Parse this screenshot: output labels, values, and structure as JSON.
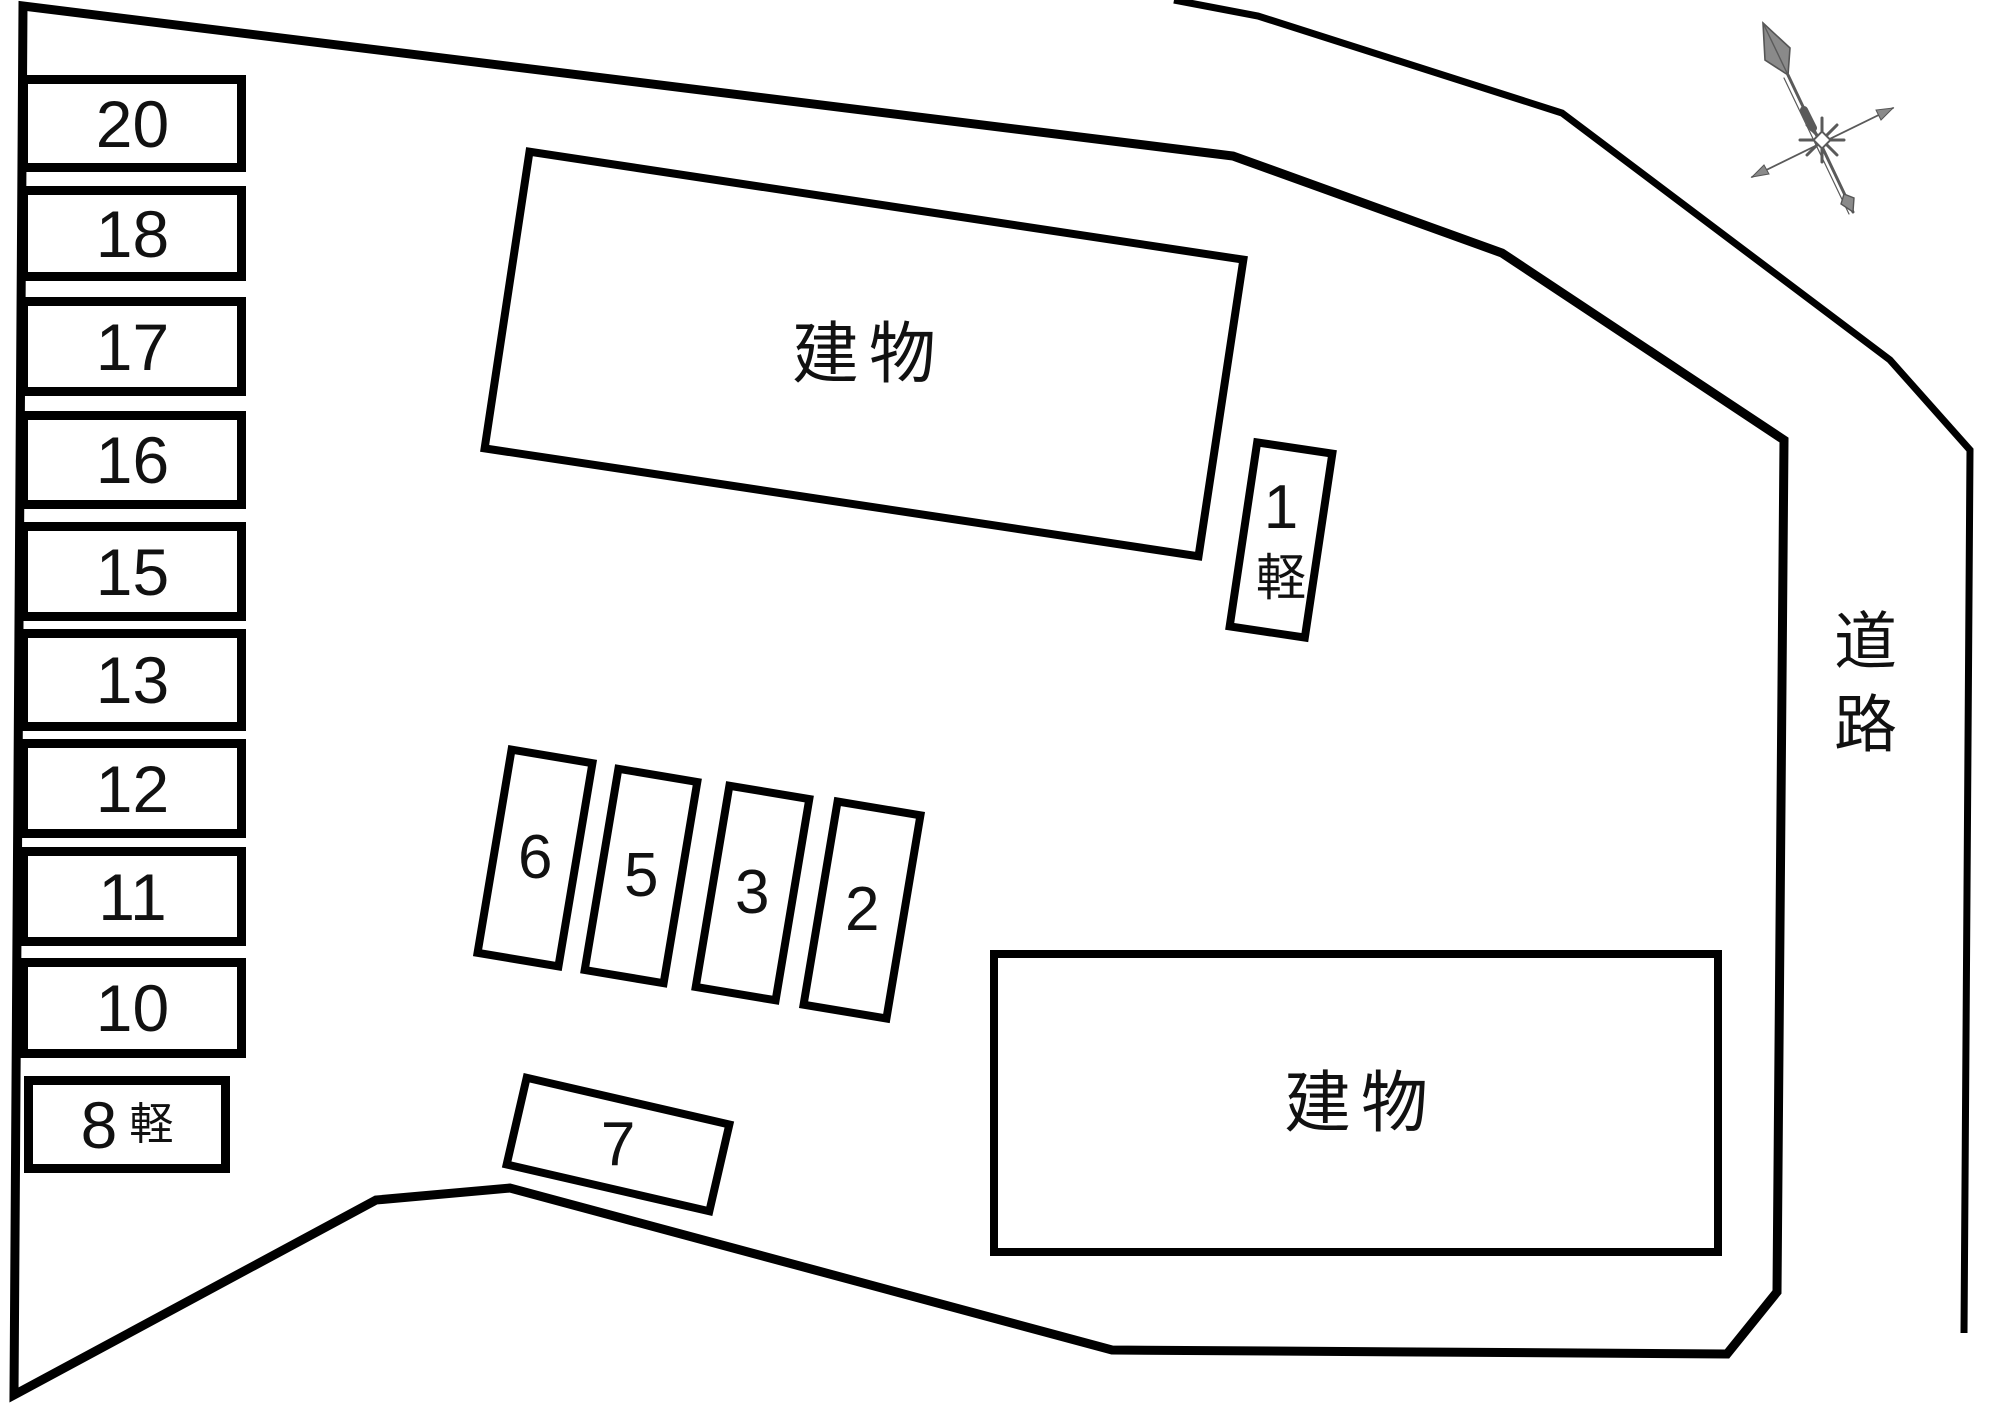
{
  "colors": {
    "background": "#ffffff",
    "line": "#000000",
    "compass": "#5a5a5a"
  },
  "buildings": {
    "top": {
      "label": "建物"
    },
    "bottom": {
      "label": "建物"
    }
  },
  "road": {
    "label": "道路"
  },
  "spaces": {
    "left": [
      {
        "label": "20"
      },
      {
        "label": "18"
      },
      {
        "label": "17"
      },
      {
        "label": "16"
      },
      {
        "label": "15"
      },
      {
        "label": "13"
      },
      {
        "label": "12"
      },
      {
        "label": "11"
      },
      {
        "label": "10"
      }
    ],
    "space8": {
      "number": "8",
      "suffix": "軽"
    },
    "space1": {
      "number": "1",
      "suffix": "軽"
    },
    "row": [
      {
        "label": "6"
      },
      {
        "label": "5"
      },
      {
        "label": "3"
      },
      {
        "label": "2"
      }
    ],
    "space7": {
      "label": "7"
    }
  },
  "compass": {
    "icon": "compass-rose-icon"
  }
}
